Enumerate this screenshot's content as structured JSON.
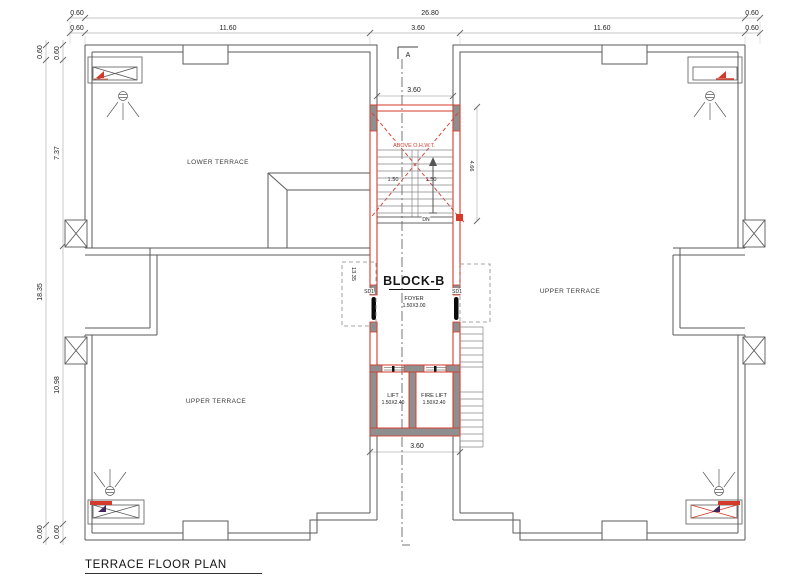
{
  "title": "TERRACE FLOOR PLAN",
  "section": {
    "marker": "A"
  },
  "dims": {
    "top1": [
      "0.60",
      "26.80",
      "0.60"
    ],
    "top2": [
      "0.60",
      "11.60",
      "3.60",
      "11.60",
      "0.60"
    ],
    "left_outer": [
      "0.60",
      "18.35",
      "0.60"
    ],
    "left_inner": [
      "0.60",
      "7.37",
      "10.98",
      "0.60"
    ],
    "notch_top": "3.60",
    "notch_bottom": "3.60",
    "flight_left": "1.50",
    "flight_right": "1.50",
    "stair_well": "4.66",
    "foyer_side": "13.35"
  },
  "labels": {
    "lower_terrace": "LOWER TERRACE",
    "upper_terrace_right": "UPPER TERRACE",
    "upper_terrace_left": "UPPER TERRACE",
    "block": "BLOCK-B",
    "foyer": "FOYER",
    "foyer_size": "1.50X3.00",
    "lift": "LIFT",
    "lift_size": "1.50X2.40",
    "fire_lift": "FIRE LIFT",
    "fire_lift_size": "1.50X2.40",
    "sd_left": "SD1",
    "sd_right": "SD1",
    "dn": "DN",
    "above_tank": "ABOVE O.H.W.T."
  },
  "colors": {
    "wall": "#5a5a5a",
    "red": "#d43a2a",
    "gray_fill": "#8f8f8f",
    "dim_line": "#b5b5b5",
    "text": "#222222"
  }
}
